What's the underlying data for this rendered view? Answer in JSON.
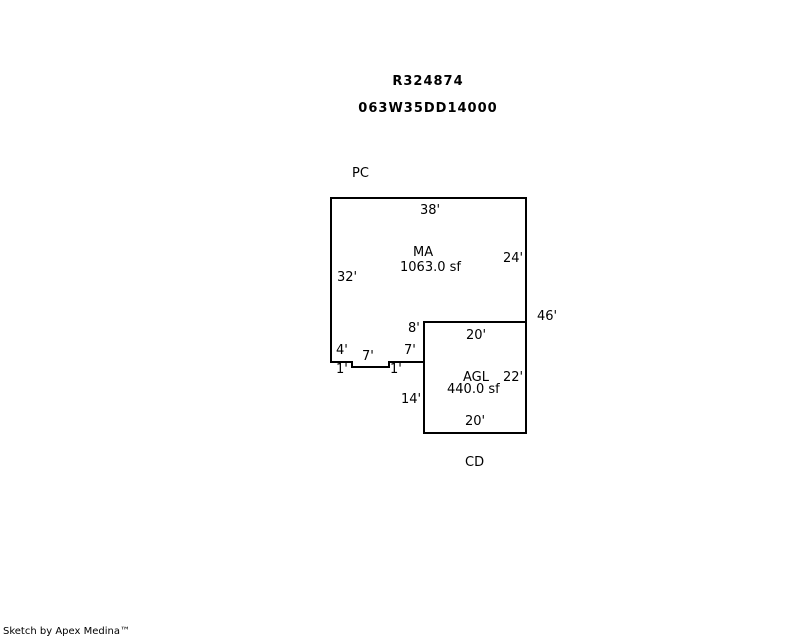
{
  "header": {
    "title_lines": [
      "R324874",
      "063W35DD14000"
    ]
  },
  "sketch": {
    "line_color": "#000000",
    "canvas": {
      "width": 800,
      "height": 640
    },
    "paths": [
      {
        "name": "building-outline",
        "points": [
          [
            331,
            363
          ],
          [
            331,
            198
          ],
          [
            526,
            198
          ],
          [
            526,
            433
          ],
          [
            424,
            433
          ],
          [
            424,
            322
          ],
          [
            527,
            322
          ]
        ]
      },
      {
        "name": "notch-bottom-edge",
        "points": [
          [
            330,
            362
          ],
          [
            352,
            362
          ],
          [
            352,
            367
          ],
          [
            389,
            367
          ],
          [
            389,
            362
          ],
          [
            425,
            362
          ]
        ]
      }
    ],
    "labels": [
      {
        "name": "area-code-pc",
        "text": "PC",
        "x": 352,
        "y": 167
      },
      {
        "name": "dim-38-top",
        "text": "38'",
        "x": 420,
        "y": 204
      },
      {
        "name": "area-ma",
        "text": "MA",
        "x": 413,
        "y": 246
      },
      {
        "name": "area-ma-sqft",
        "text": "1063.0 sf",
        "x": 400,
        "y": 261
      },
      {
        "name": "dim-32-left",
        "text": "32'",
        "x": 337,
        "y": 271
      },
      {
        "name": "dim-24-right",
        "text": "24'",
        "x": 503,
        "y": 252
      },
      {
        "name": "dim-46-right",
        "text": "46'",
        "x": 537,
        "y": 310
      },
      {
        "name": "dim-8",
        "text": "8'",
        "x": 408,
        "y": 322
      },
      {
        "name": "dim-20-agl-top",
        "text": "20'",
        "x": 466,
        "y": 329
      },
      {
        "name": "dim-4",
        "text": "4'",
        "x": 336,
        "y": 344
      },
      {
        "name": "dim-7-right",
        "text": "7'",
        "x": 404,
        "y": 344
      },
      {
        "name": "dim-7-mid",
        "text": "7'",
        "x": 362,
        "y": 350
      },
      {
        "name": "dim-1-left",
        "text": "1'",
        "x": 336,
        "y": 363
      },
      {
        "name": "dim-1-right",
        "text": "1'",
        "x": 390,
        "y": 363
      },
      {
        "name": "area-agl",
        "text": "AGL",
        "x": 463,
        "y": 371
      },
      {
        "name": "dim-22-right",
        "text": "22'",
        "x": 503,
        "y": 371
      },
      {
        "name": "area-agl-sqft",
        "text": "440.0 sf",
        "x": 447,
        "y": 383
      },
      {
        "name": "dim-14-left",
        "text": "14'",
        "x": 401,
        "y": 393
      },
      {
        "name": "dim-20-agl-bottom",
        "text": "20'",
        "x": 465,
        "y": 415
      },
      {
        "name": "area-code-cd",
        "text": "CD",
        "x": 465,
        "y": 456
      }
    ]
  },
  "footer": {
    "credit": "Sketch by Apex Medina™"
  }
}
